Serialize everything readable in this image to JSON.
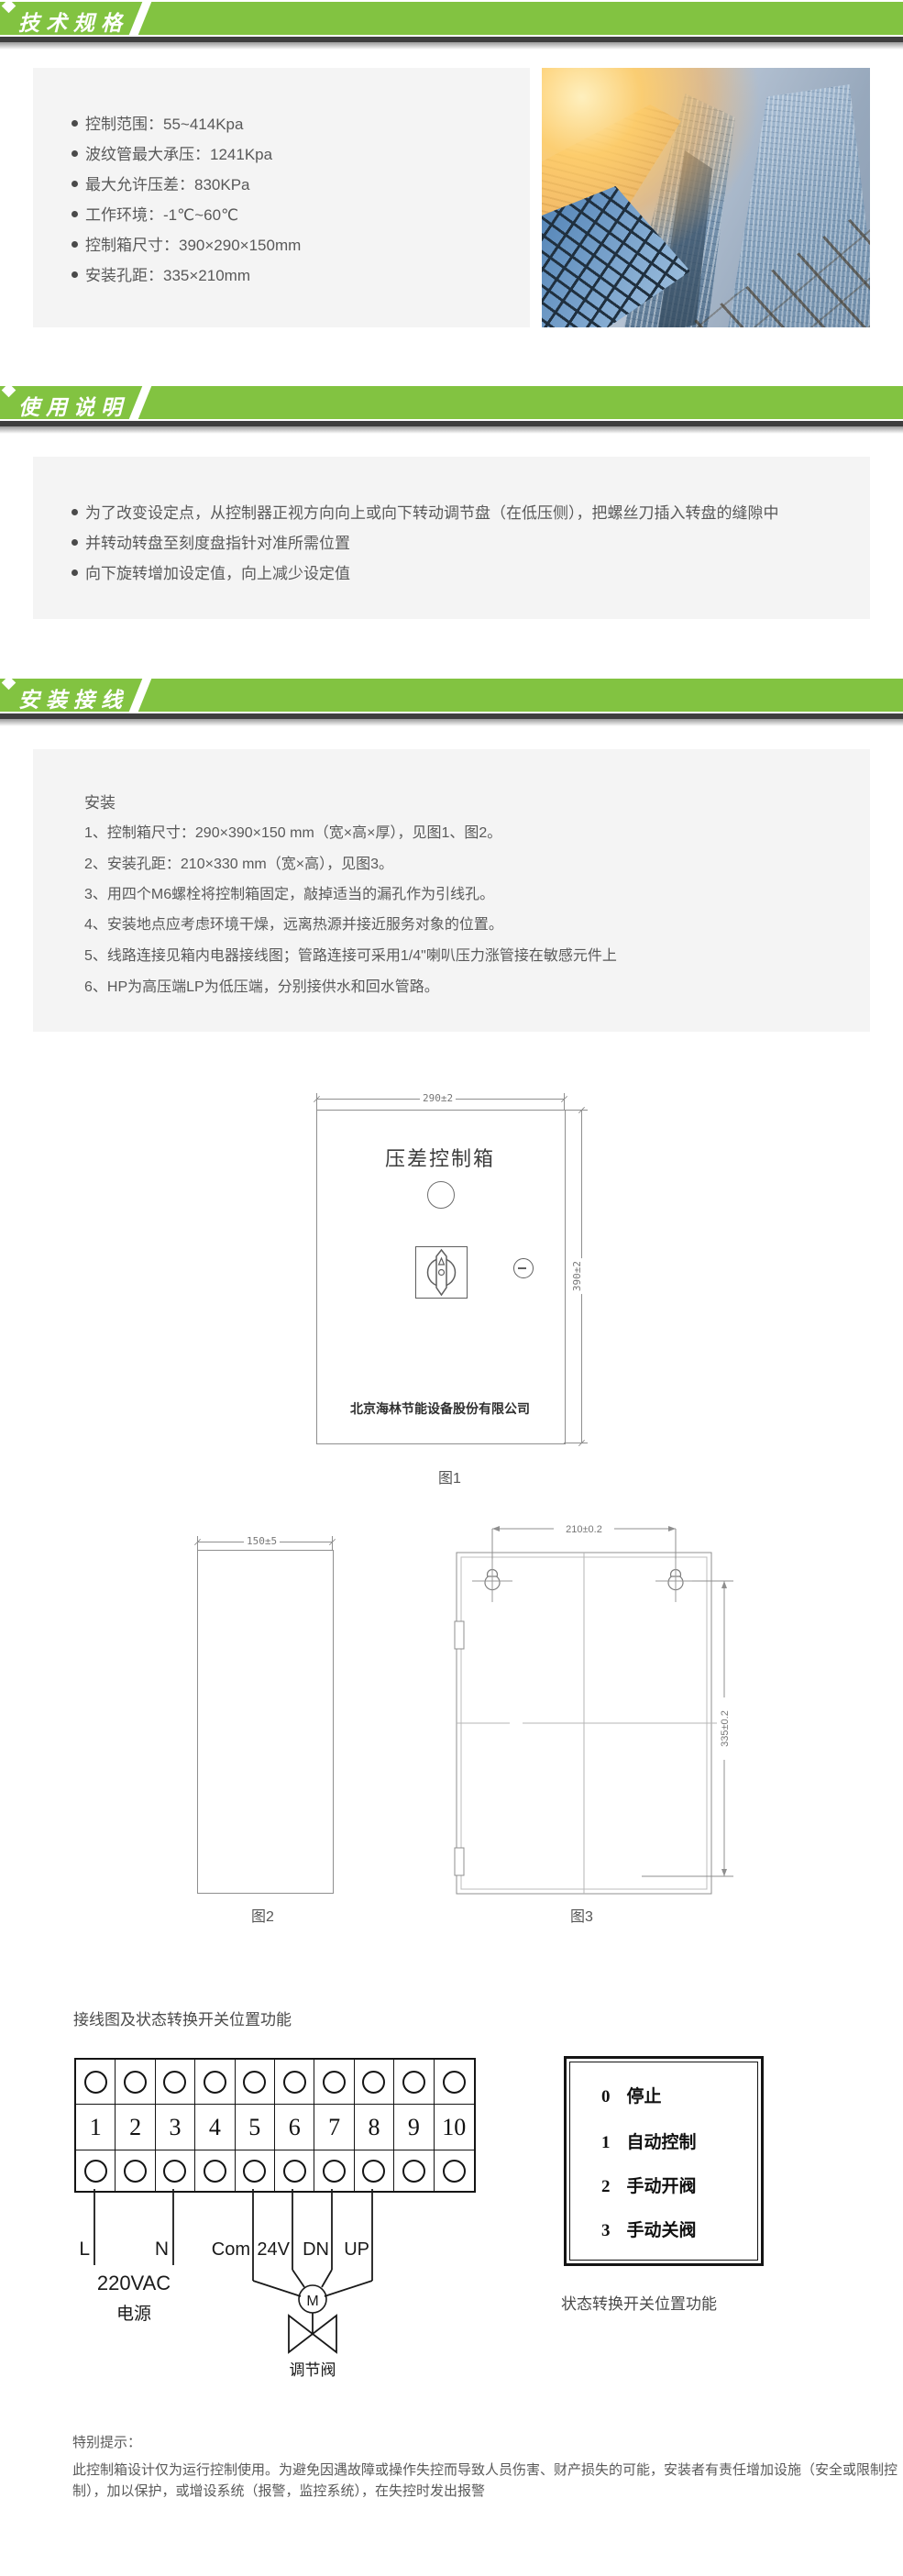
{
  "theme": {
    "accent_green": "#82C341",
    "header_bar": "#3E3E3E",
    "panel_bg": "#F4F4F4",
    "body_text": "#595959",
    "diagram_ink": "#141414",
    "cad_gray": "#8f8f8f"
  },
  "sections": {
    "specs": {
      "title": "技术规格",
      "bullets": [
        "控制范围：55~414Kpa",
        "波纹管最大承压：1241Kpa",
        "最大允许压差：830KPa",
        "工作环境：-1℃~60℃",
        "控制箱尺寸：390×290×150mm",
        "安装孔距：335×210mm"
      ]
    },
    "usage": {
      "title": "使用说明",
      "bullets": [
        "为了改变设定点，从控制器正视方向向上或向下转动调节盘（在低压侧），把螺丝刀插入转盘的缝隙中",
        "并转动转盘至刻度盘指针对准所需位置",
        "向下旋转增加设定值，向上减少设定值"
      ]
    },
    "install": {
      "title": "安装接线",
      "subtitle": "安装",
      "steps": [
        "1、控制箱尺寸：290×390×150 mm（宽×高×厚），见图1、图2。",
        "2、安装孔距：210×330 mm（宽×高），见图3。",
        "3、用四个M6螺栓将控制箱固定，敲掉适当的漏孔作为引线孔。",
        "4、安装地点应考虑环境干燥，远离热源并接近服务对象的位置。",
        "5、线路连接见箱内电器接线图；管路连接可采用1/4\"喇叭压力涨管接在敏感元件上",
        "6、HP为高压端LP为低压端，分别接供水和回水管路。"
      ]
    }
  },
  "figures": {
    "fig1": {
      "caption": "图1",
      "width_dim": "290±2",
      "height_dim": "390±2",
      "panel_label": "压差控制箱",
      "company": "北京海林节能设备股份有限公司"
    },
    "fig2": {
      "caption": "图2",
      "width_dim": "150±5"
    },
    "fig3": {
      "caption": "图3",
      "width_dim": "210±0.2",
      "height_dim": "335±0.2"
    }
  },
  "wiring": {
    "heading": "接线图及状态转换开关位置功能",
    "terminals": [
      "1",
      "2",
      "3",
      "4",
      "5",
      "6",
      "7",
      "8",
      "9",
      "10"
    ],
    "labels": {
      "line": "L",
      "neutral": "N",
      "com": "Com",
      "v24": "24V",
      "down": "DN",
      "up": "UP",
      "voltage": "220VAC",
      "power": "电源",
      "motor": "M",
      "valve": "调节阀"
    }
  },
  "switchbox": {
    "items": [
      {
        "num": "0",
        "label": "停止"
      },
      {
        "num": "1",
        "label": "自动控制"
      },
      {
        "num": "2",
        "label": "手动开阀"
      },
      {
        "num": "3",
        "label": "手动关阀"
      }
    ],
    "caption": "状态转换开关位置功能"
  },
  "notice": {
    "title": "特别提示：",
    "lines": [
      "此控制箱设计仅为运行控制使用。为避免因遇故障或操作失控而导致人员伤害、财产损失的可能，安装者有责任增加设施（安全或限制控",
      "制），加以保护，或增设系统（报警，监控系统），在失控时发出报警"
    ]
  }
}
